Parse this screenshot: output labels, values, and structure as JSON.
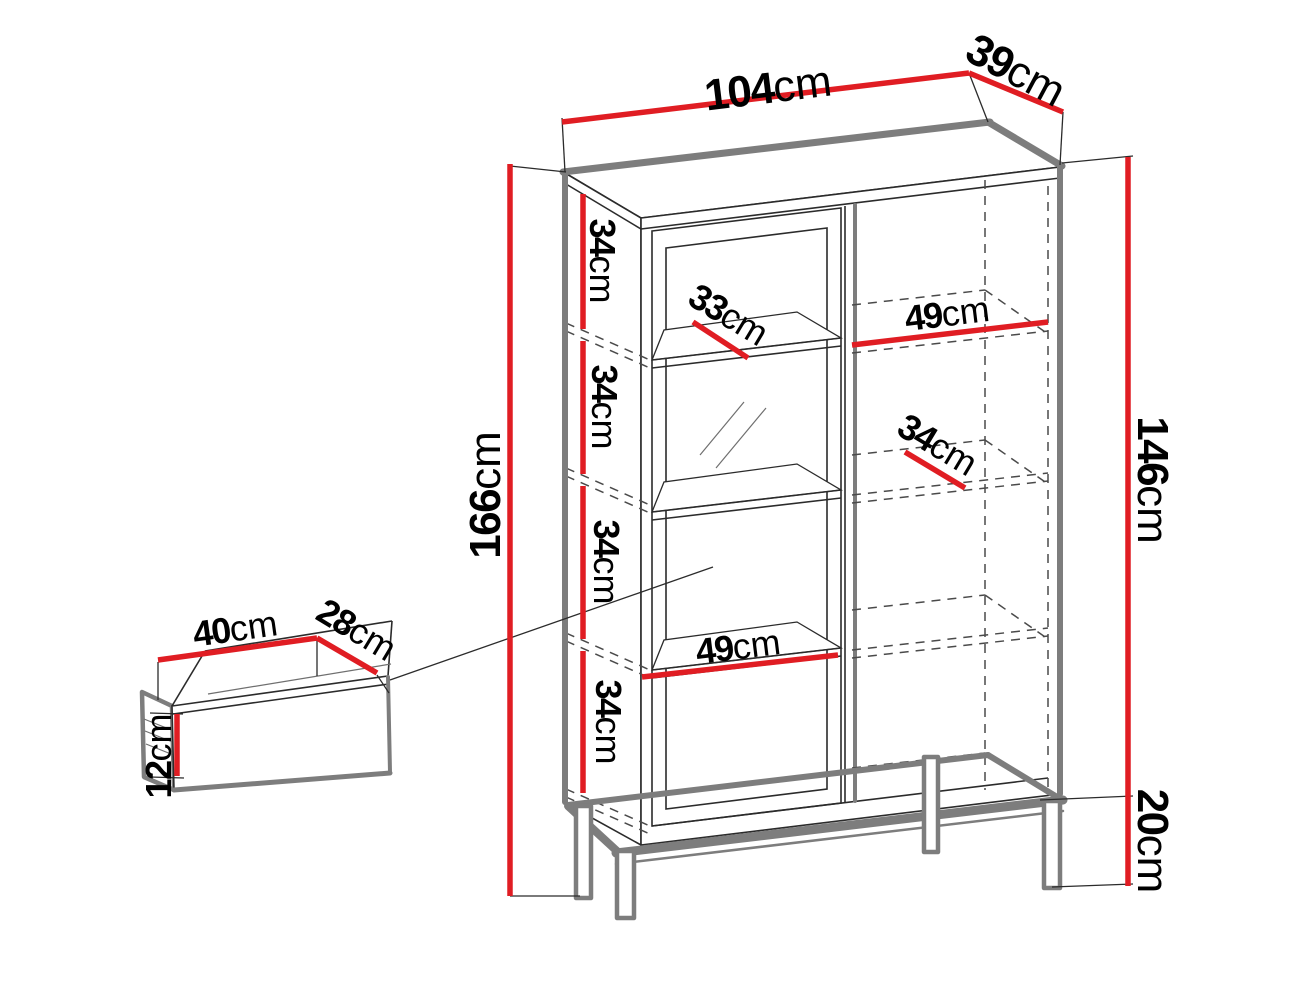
{
  "diagram": {
    "kind": "furniture-dimension-diagram",
    "subject": "display cabinet with glass door, open shelves, metal leg frame and separate drawer"
  },
  "colors": {
    "dimension_red": "#e01d23",
    "outline_gray": "#7d7d7d",
    "line_black": "#2b2b2b",
    "background": "#ffffff"
  },
  "labels": {
    "top_width": {
      "num": "104",
      "unit": "cm"
    },
    "top_depth": {
      "num": "39",
      "unit": "cm"
    },
    "total_height": {
      "num": "166",
      "unit": "cm"
    },
    "body_height": {
      "num": "146",
      "unit": "cm"
    },
    "leg_height": {
      "num": "20",
      "unit": "cm"
    },
    "compartment_1": {
      "num": "34",
      "unit": "cm"
    },
    "compartment_2": {
      "num": "34",
      "unit": "cm"
    },
    "compartment_3": {
      "num": "34",
      "unit": "cm"
    },
    "compartment_4": {
      "num": "34",
      "unit": "cm"
    },
    "left_shelf_depth": {
      "num": "33",
      "unit": "cm"
    },
    "right_shelf_width": {
      "num": "49",
      "unit": "cm"
    },
    "right_shelf_depth": {
      "num": "34",
      "unit": "cm"
    },
    "left_shelf_width": {
      "num": "49",
      "unit": "cm"
    },
    "drawer_width": {
      "num": "40",
      "unit": "cm"
    },
    "drawer_depth": {
      "num": "28",
      "unit": "cm"
    },
    "drawer_height": {
      "num": "12",
      "unit": "cm"
    }
  }
}
